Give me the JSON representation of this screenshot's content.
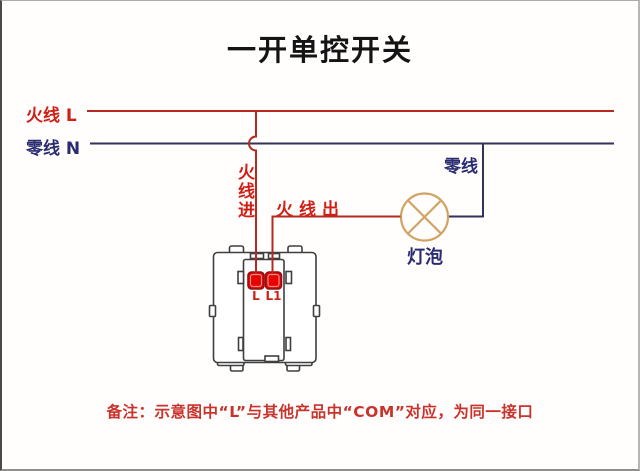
{
  "title": "一开单控开关",
  "bus": {
    "live_label": "火线 L",
    "neutral_label": "零线 N"
  },
  "branches": {
    "live_in_label": "火线进",
    "live_out_label": "火线出",
    "neutral_label": "零线"
  },
  "bulb": {
    "label": "灯泡",
    "symbol": "circle-with-cross"
  },
  "switch": {
    "terminal_left_label": "L",
    "terminal_right_label": "L1"
  },
  "note": "备注：示意图中“L”与其他产品中“COM”对应，为同一接口",
  "colors": {
    "live_wire": "#b5291f",
    "live_label": "#cf1f16",
    "neutral_wire": "#333357",
    "neutral_label": "#2b2b72",
    "bulb_outline": "#d2a263",
    "switch_outline": "#3f3f3f",
    "terminal_fill": "#e80000",
    "note_text": "#ca332c",
    "title_text": "#141414"
  }
}
